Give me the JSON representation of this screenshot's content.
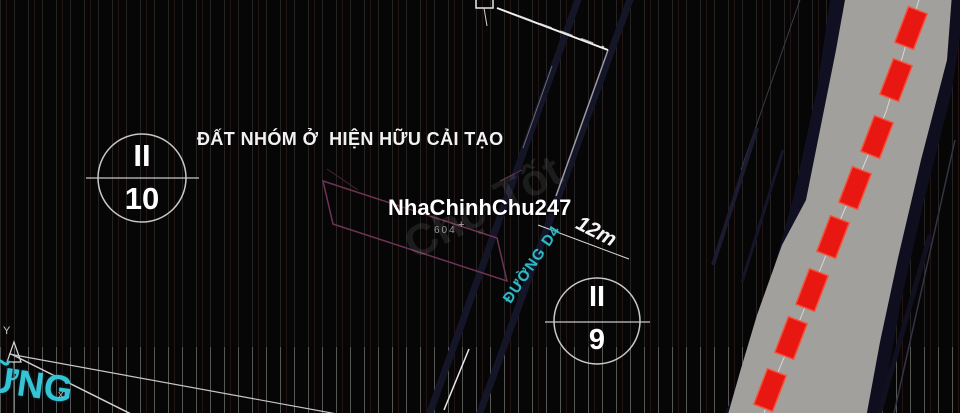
{
  "map": {
    "title": "ĐẤT NHÓM Ở  HIỆN HỮU CẢI TẠO",
    "watermark_primary": "NhaChinhChu247",
    "watermark_secondary": "Chợ Tốt",
    "parcel_number": "604",
    "plus_marker": "+",
    "road": {
      "name": "ĐƯỜNG D4",
      "width_label": "12m"
    },
    "zone_markers": [
      {
        "id": "II-10",
        "group": "II",
        "number": "10"
      },
      {
        "id": "II-9",
        "group": "II",
        "number": "9"
      }
    ],
    "corner_road_label_fragment": "ỮNG",
    "axis_label": "Y",
    "boundary_marker": "x",
    "colors": {
      "background": "#060606",
      "road_label_cyan": "#2fb9c9",
      "planning_red": "#e81711",
      "corridor_gray": "#a2a09d",
      "parcel_outline": "#6d3352",
      "text_white": "#f2f2f2"
    }
  }
}
